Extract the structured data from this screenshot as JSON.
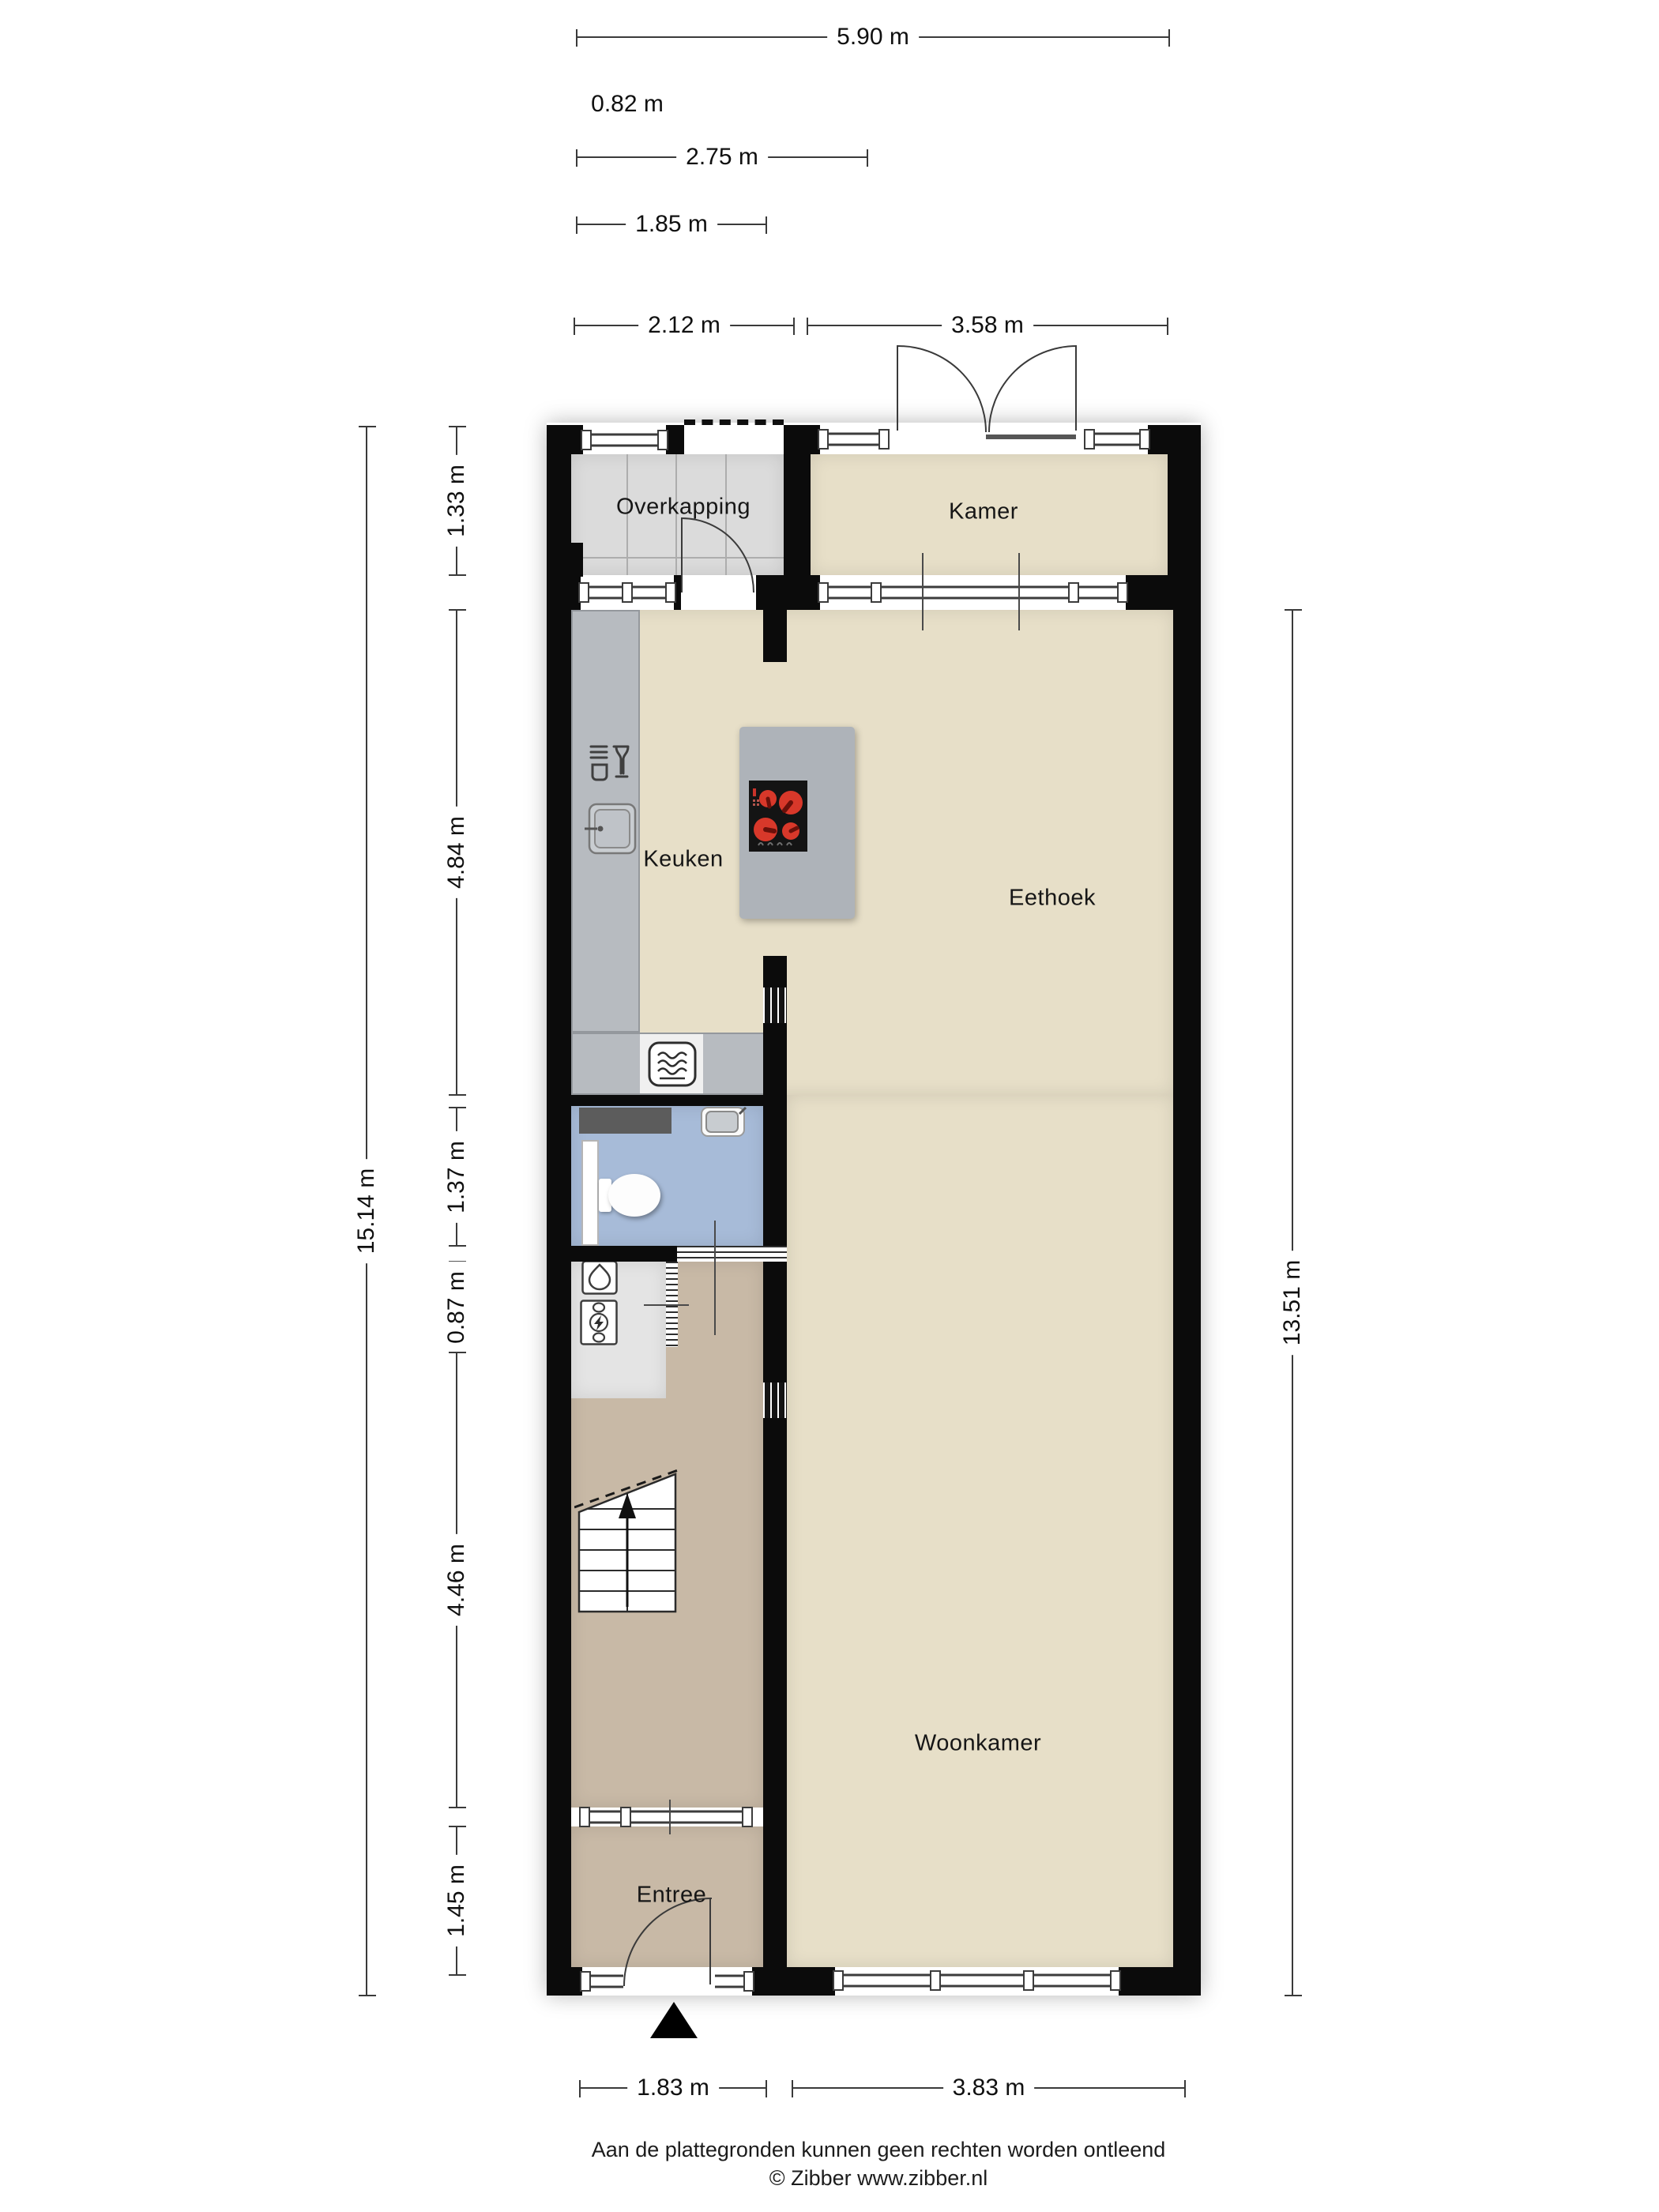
{
  "rooms": {
    "overkapping": "Overkapping",
    "kamer": "Kamer",
    "keuken": "Keuken",
    "eethoek": "Eethoek",
    "woonkamer": "Woonkamer",
    "entree": "Entree"
  },
  "dimensions": {
    "top": {
      "d590": "5.90 m",
      "d082": "0.82 m",
      "d275": "2.75 m",
      "d185": "1.85 m",
      "d212": "2.12 m",
      "d358": "3.58 m"
    },
    "left": {
      "overall": "15.14 m",
      "segments": {
        "s133": "1.33 m",
        "s484": "4.84 m",
        "s137": "1.37 m",
        "s087": "0.87 m",
        "s446": "4.46 m",
        "s145": "1.45 m"
      }
    },
    "right": {
      "overall": "13.51 m"
    },
    "bottom": {
      "d183": "1.83 m",
      "d383": "3.83 m"
    }
  },
  "footer": {
    "disclaimer": "Aan de plattegronden kunnen geen rechten worden ontleend",
    "credit": "© Zibber www.zibber.nl"
  }
}
